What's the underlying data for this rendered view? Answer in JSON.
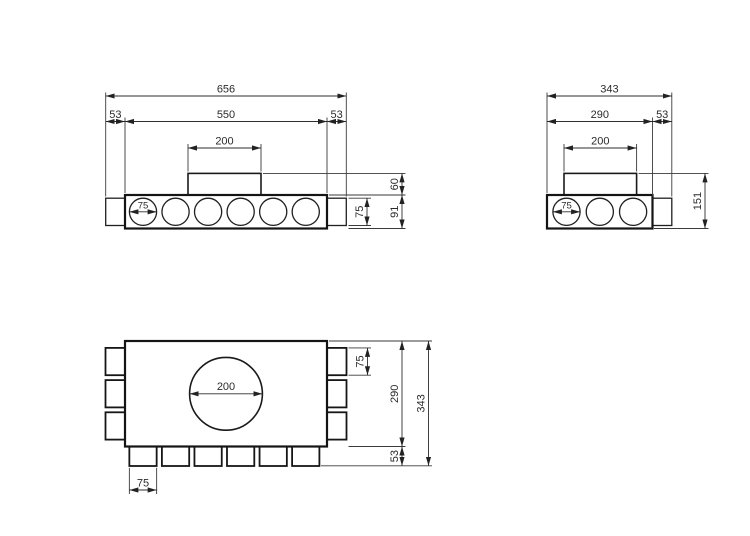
{
  "canvas": {
    "background": "#ffffff",
    "line_color": "#1a1a1a"
  },
  "front": {
    "overall_width": "656",
    "left_end_width": "53",
    "body_width": "550",
    "right_end_width": "53",
    "spigot_width": "200",
    "spigot_height": "60",
    "end_cap_height": "75",
    "body_height": "91",
    "port_diameter": "75"
  },
  "side": {
    "overall_width": "343",
    "body_width": "290",
    "end_width": "53",
    "spigot_width": "200",
    "overall_height": "151",
    "port_diameter": "75"
  },
  "plan": {
    "side_port_width": "75",
    "body_depth": "290",
    "overall_depth": "343",
    "bottom_port_depth": "53",
    "spigot_diameter": "200",
    "bottom_port_width": "75"
  }
}
